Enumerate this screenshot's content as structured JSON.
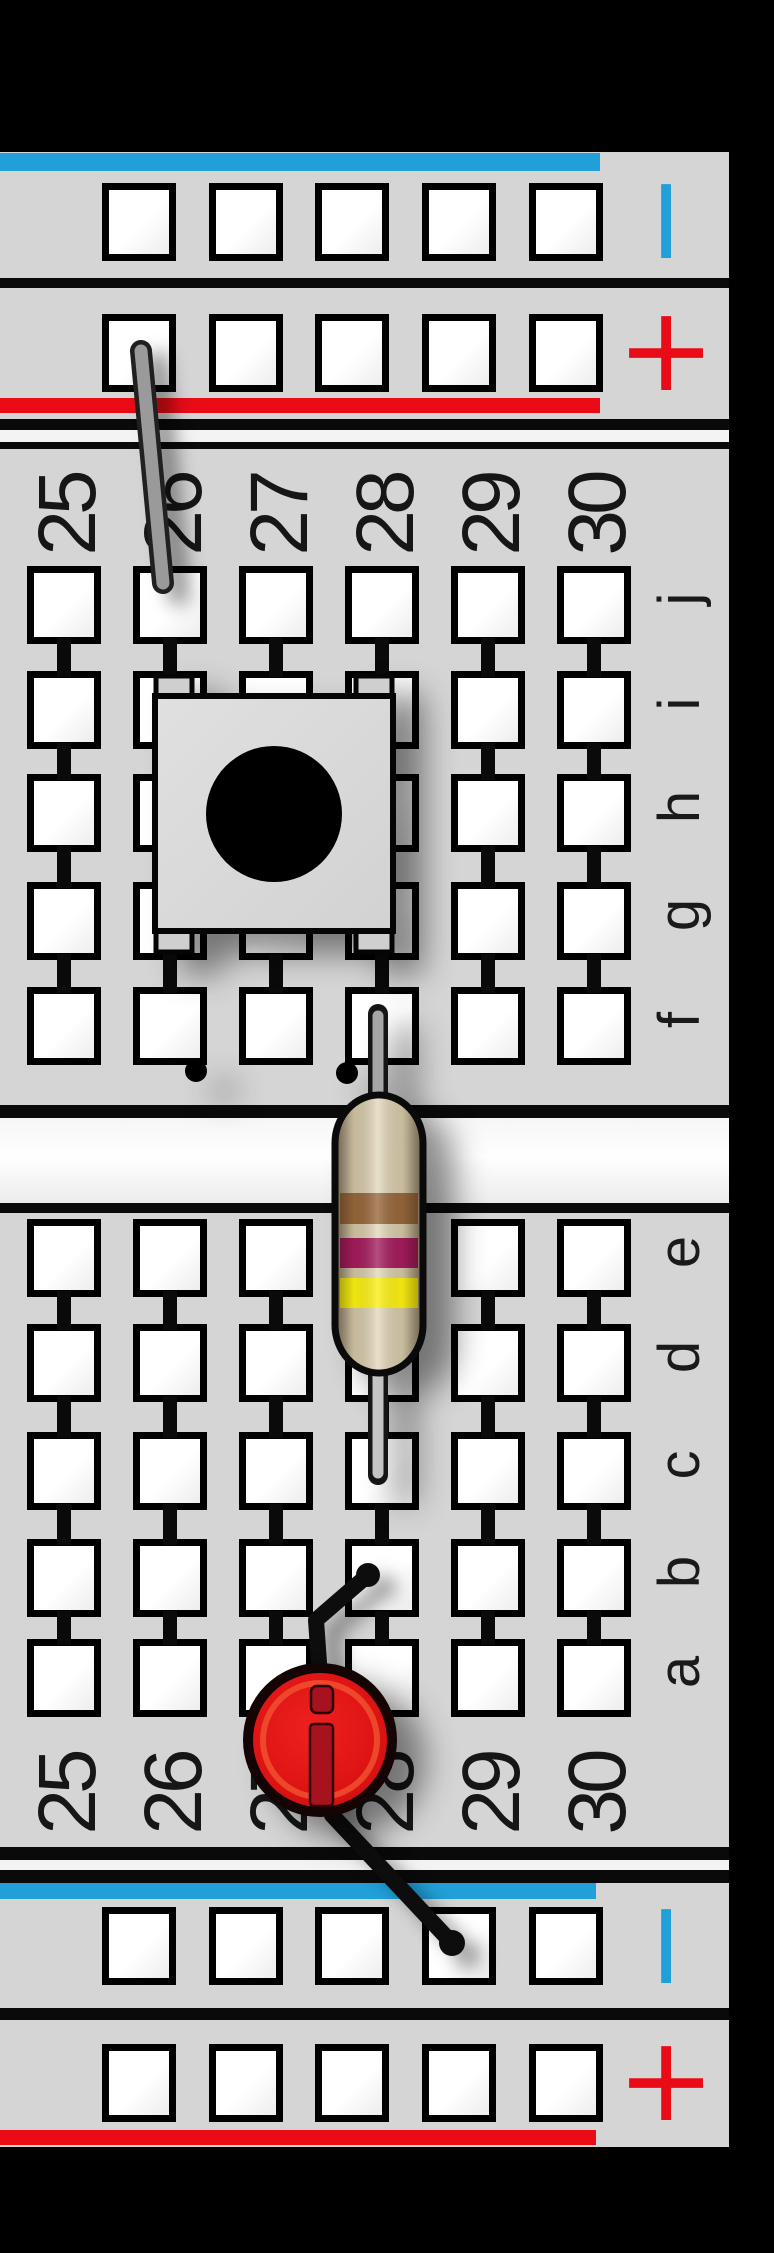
{
  "board": {
    "kind": "breadboard strip, columns 25-30 (Fritzing style)",
    "column_labels": [
      "25",
      "26",
      "27",
      "28",
      "29",
      "30"
    ],
    "row_labels_upper": [
      "j",
      "i",
      "h",
      "g",
      "f"
    ],
    "row_labels_lower": [
      "e",
      "d",
      "c",
      "b",
      "a"
    ],
    "rails": {
      "negative_symbol": "−",
      "positive_symbol": "+",
      "negative_color": "#219FD9",
      "positive_color": "#E90C17"
    },
    "colors": {
      "background": "#000000",
      "board_gray": "#D5D5D5",
      "hole_fill": "#FFFFFF",
      "outline": "#0A0A0A",
      "channel_white": "#F6F6F6"
    }
  },
  "components": {
    "gray_jumper": {
      "label": "gray jumper wire",
      "color": "#9A9A9A",
      "from_hole": "top + rail, 1st hole",
      "to_hole": "j26"
    },
    "pushbutton": {
      "label": "pushbutton (top view)",
      "body_color": "#DADADA",
      "cap_color": "#000000",
      "span": "columns 26-28, rows g-i"
    },
    "resistor": {
      "label": "axial resistor",
      "body_color": "#D5C8A8",
      "band_names": [
        "brown",
        "violet",
        "yellow"
      ],
      "band_colors": [
        "#96663A",
        "#A31B5C",
        "#FAEE11"
      ],
      "from_hole": "f28",
      "to_hole": "c28"
    },
    "black_jumper": {
      "label": "black jumper wire",
      "color": "#0D0D0D",
      "from_hole": "b28",
      "to_hole": "bottom − rail, 4th hole"
    },
    "led": {
      "label": "red LED (top view)",
      "body_color": "#DF1414",
      "marker_color": "#A7121F",
      "position": "row a, columns 27-28"
    }
  }
}
